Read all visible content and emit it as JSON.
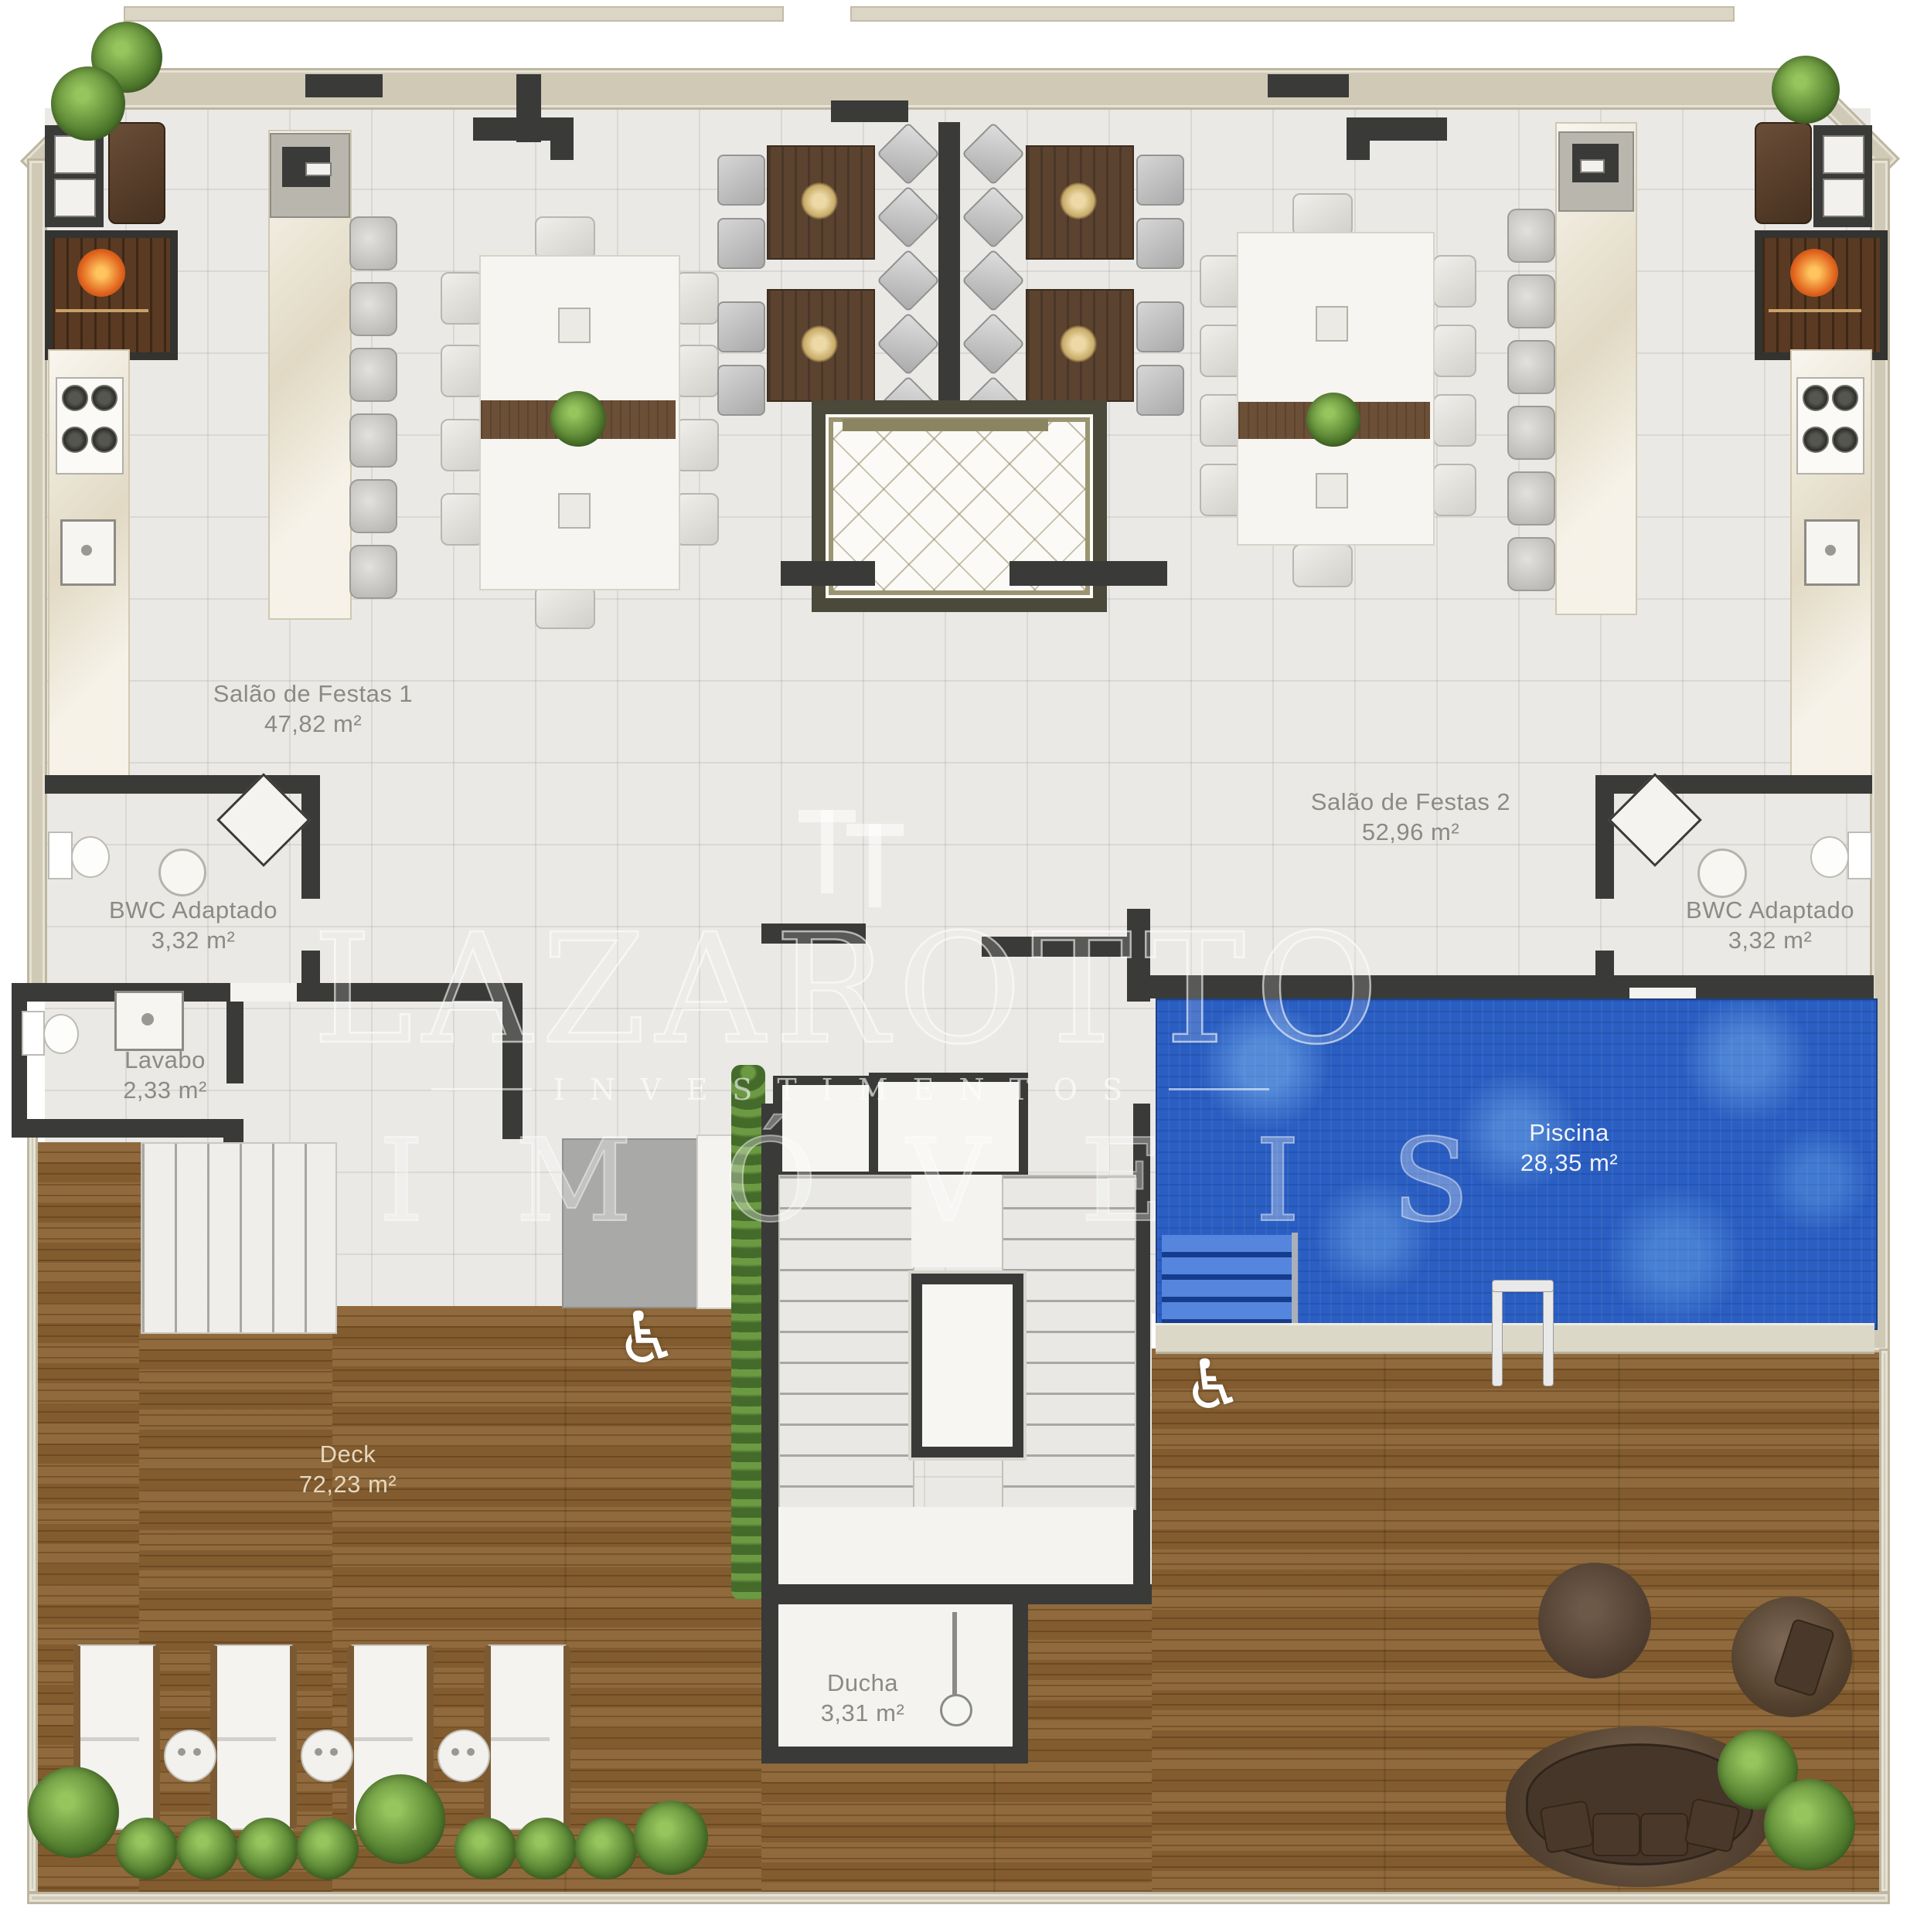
{
  "watermark": {
    "brand": "LAZAROTTO",
    "subtitle": "INVESTIMENTOS",
    "line2": "IMÓVEIS"
  },
  "rooms": [
    {
      "id": "salao1",
      "name": "Salão de Festas 1",
      "area": "47,82 m²"
    },
    {
      "id": "salao2",
      "name": "Salão de Festas 2",
      "area": "52,96 m²"
    },
    {
      "id": "bwc_left",
      "name": "BWC Adaptado",
      "area": "3,32 m²"
    },
    {
      "id": "bwc_right",
      "name": "BWC Adaptado",
      "area": "3,32 m²"
    },
    {
      "id": "lavabo",
      "name": "Lavabo",
      "area": "2,33 m²"
    },
    {
      "id": "deck",
      "name": "Deck",
      "area": "72,23 m²"
    },
    {
      "id": "piscina",
      "name": "Piscina",
      "area": "28,35 m²"
    },
    {
      "id": "ducha",
      "name": "Ducha",
      "area": "3,31 m²"
    }
  ],
  "icons": {
    "wheelchair": "♿"
  },
  "colors": {
    "outer_wall": "#cfc9b6",
    "inner_wall": "#3a3a38",
    "floor": "#eae9e5",
    "deck_wood": "#8a6232",
    "pool_water": "#2a5ec2",
    "label_text": "#8b8b85",
    "watermark": "#ffffff"
  }
}
